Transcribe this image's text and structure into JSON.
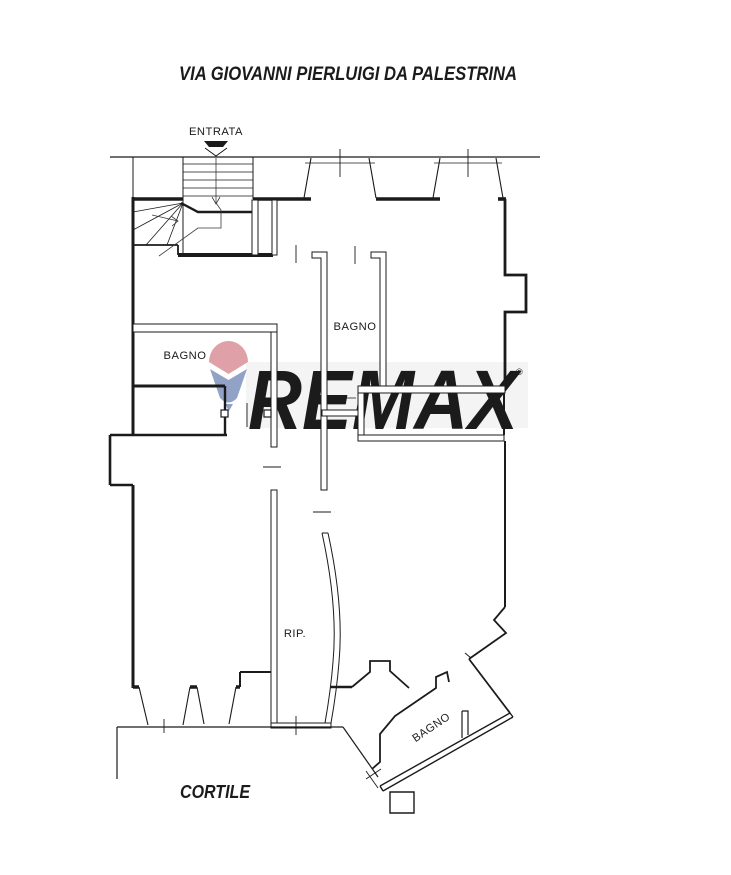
{
  "title": "VIA GIOVANNI PIERLUIGI DA PALESTRINA",
  "labels": {
    "entrance": "ENTRATA",
    "bathroom_left": "BAGNO",
    "bathroom_center": "BAGNO",
    "bathroom_corner": "BAGNO",
    "storage": "RIP.",
    "courtyard": "CORTILE"
  },
  "watermark": {
    "brand": "REMAX",
    "registered": "®",
    "text_color": "#c9c9c9",
    "band_color": "#f4f4f4",
    "balloon_red": "#dfa0a8",
    "balloon_blue": "#92a2c6"
  },
  "plan": {
    "wall_color": "#1b1b1b",
    "background": "#ffffff"
  }
}
